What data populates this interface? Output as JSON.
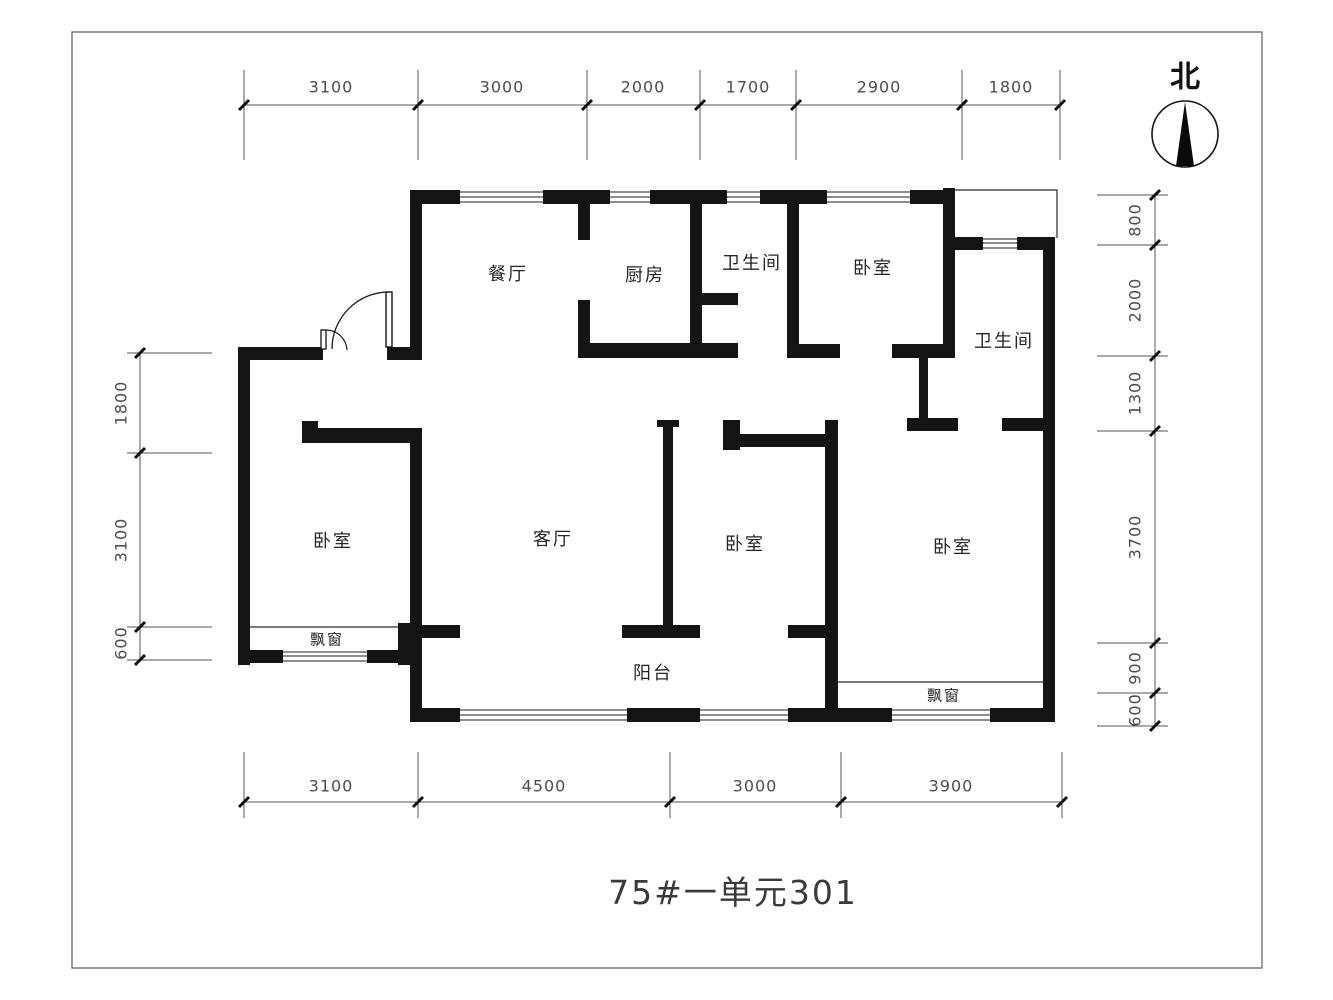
{
  "title": {
    "text": "75#一单元301"
  },
  "north": {
    "label": "北"
  },
  "rooms": [
    {
      "id": "dining",
      "label": "餐厅",
      "x": 508,
      "y": 273,
      "s": 18
    },
    {
      "id": "kitchen",
      "label": "厨房",
      "x": 645,
      "y": 274,
      "s": 18
    },
    {
      "id": "bathroom-top",
      "label": "卫生间",
      "x": 752,
      "y": 262,
      "s": 18
    },
    {
      "id": "bedroom-north",
      "label": "卧室",
      "x": 873,
      "y": 267,
      "s": 18
    },
    {
      "id": "bathroom-right",
      "label": "卫生间",
      "x": 1004,
      "y": 340,
      "s": 18
    },
    {
      "id": "bedroom-west",
      "label": "卧室",
      "x": 333,
      "y": 540,
      "s": 18
    },
    {
      "id": "living-room",
      "label": "客厅",
      "x": 553,
      "y": 538,
      "s": 18
    },
    {
      "id": "bedroom-middle",
      "label": "卧室",
      "x": 745,
      "y": 543,
      "s": 18
    },
    {
      "id": "bedroom-master",
      "label": "卧室",
      "x": 953,
      "y": 546,
      "s": 18
    },
    {
      "id": "bay-window-west",
      "label": "飘窗",
      "x": 327,
      "y": 639,
      "s": 15
    },
    {
      "id": "balcony",
      "label": "阳台",
      "x": 653,
      "y": 672,
      "s": 18
    },
    {
      "id": "bay-window-master",
      "label": "飘窗",
      "x": 944,
      "y": 695,
      "s": 15
    }
  ],
  "dimensions": {
    "top": {
      "orient": "h",
      "line": 105,
      "from": 244,
      "to": 1060,
      "ext": [
        70,
        160
      ],
      "label_line": 87,
      "ticks": [
        244,
        418,
        587,
        700,
        796,
        962,
        1060
      ],
      "labels": [
        {
          "v": "3100",
          "p": 331
        },
        {
          "v": "3000",
          "p": 502
        },
        {
          "v": "2000",
          "p": 643
        },
        {
          "v": "1700",
          "p": 748
        },
        {
          "v": "2900",
          "p": 879
        },
        {
          "v": "1800",
          "p": 1011
        }
      ]
    },
    "bottom": {
      "orient": "h",
      "line": 802,
      "from": 244,
      "to": 1062,
      "ext": [
        752,
        818
      ],
      "label_line": 786,
      "ticks": [
        244,
        418,
        670,
        841,
        1062
      ],
      "labels": [
        {
          "v": "3100",
          "p": 331
        },
        {
          "v": "4500",
          "p": 544
        },
        {
          "v": "3000",
          "p": 755
        },
        {
          "v": "3900",
          "p": 951
        }
      ]
    },
    "left": {
      "orient": "v",
      "line": 140,
      "from": 353,
      "to": 660,
      "ext": [
        127,
        212
      ],
      "label_line": 121,
      "ticks": [
        353,
        453,
        627,
        660
      ],
      "labels": [
        {
          "v": "1800",
          "p": 403
        },
        {
          "v": "3100",
          "p": 540
        },
        {
          "v": "600",
          "p": 643
        }
      ]
    },
    "right": {
      "orient": "v",
      "line": 1155,
      "from": 195,
      "to": 726,
      "ext": [
        1097,
        1168
      ],
      "label_line": 1135,
      "ticks": [
        195,
        245,
        356,
        431,
        643,
        693,
        726
      ],
      "labels": [
        {
          "v": "800",
          "p": 220
        },
        {
          "v": "2000",
          "p": 300
        },
        {
          "v": "1300",
          "p": 393
        },
        {
          "v": "3700",
          "p": 537
        },
        {
          "v": "900",
          "p": 668
        },
        {
          "v": "600",
          "p": 710
        }
      ]
    }
  }
}
